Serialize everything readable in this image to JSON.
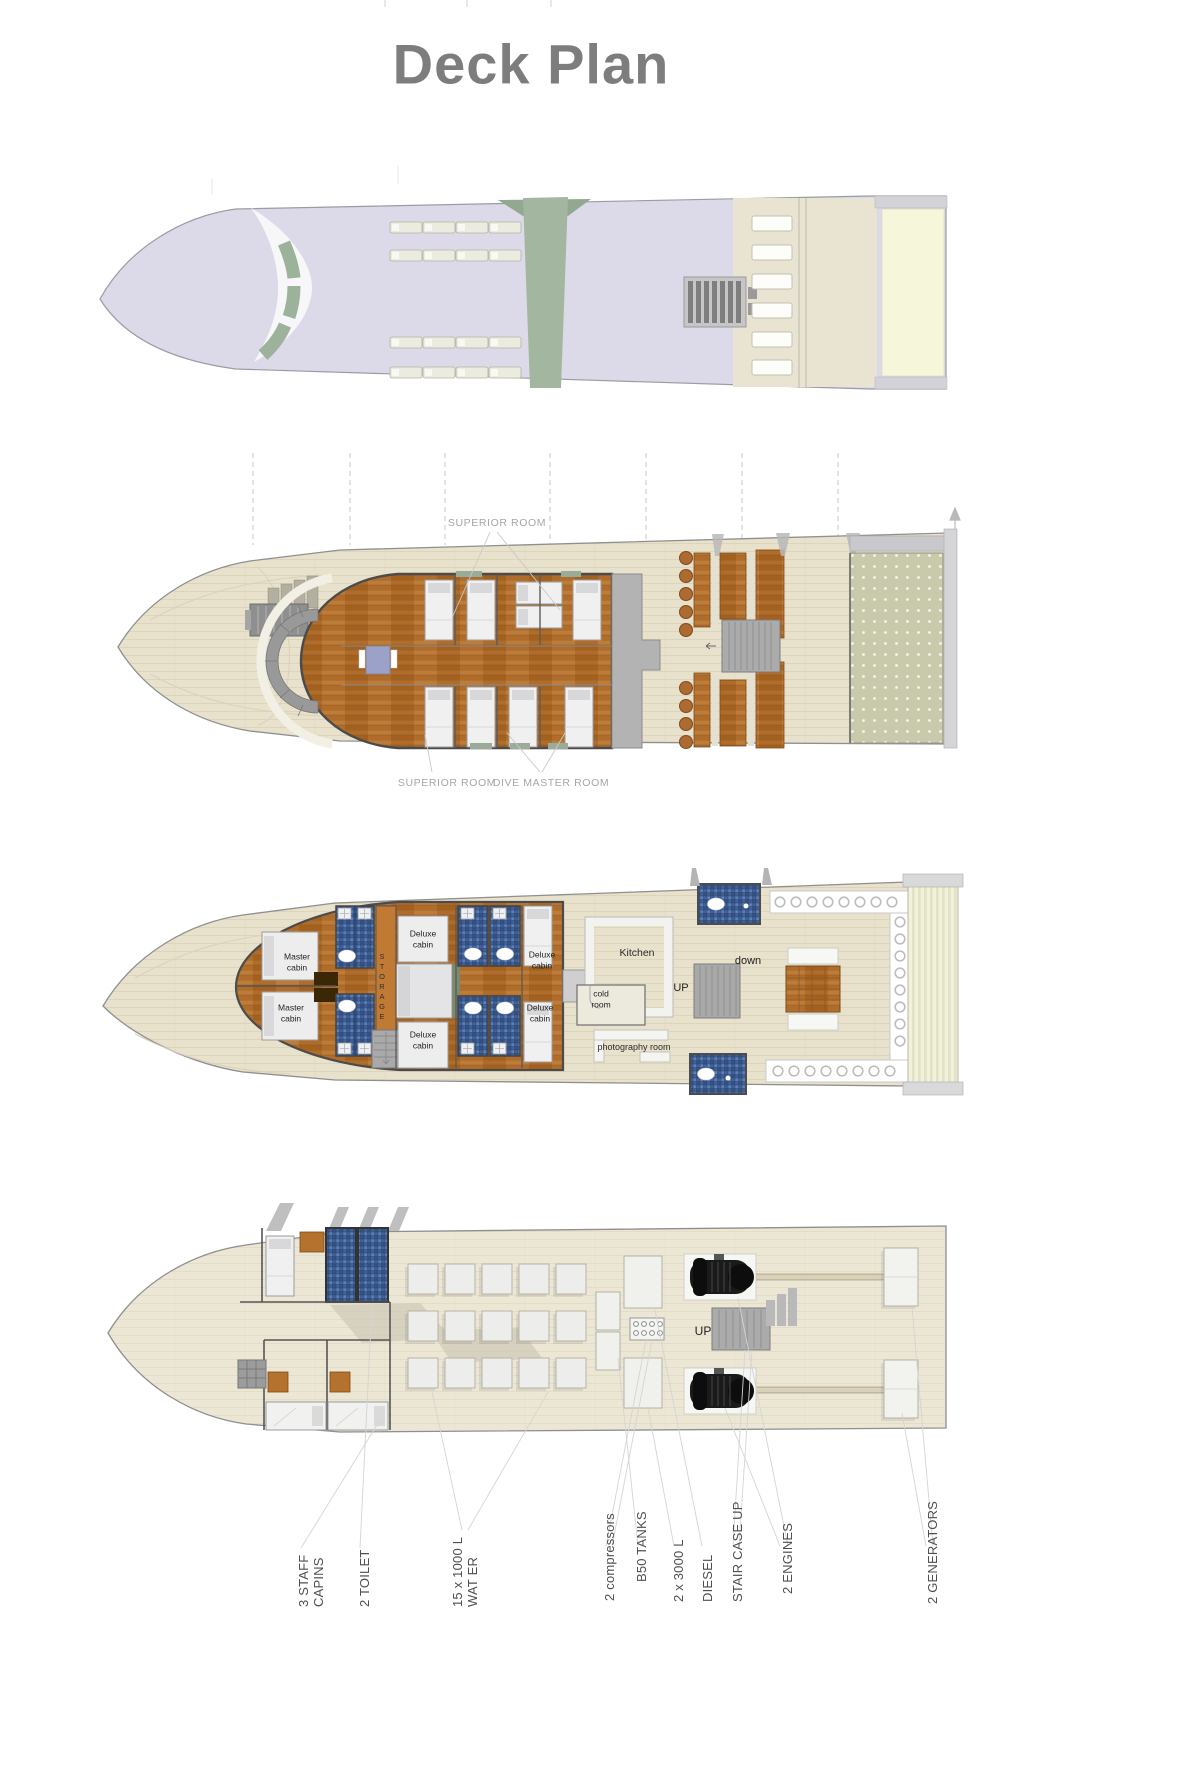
{
  "title": "Deck Plan",
  "upper_deck": {
    "superior_room_top": "SUPERIOR ROOM",
    "superior_room_bottom": "SUPERIOR ROOM",
    "dive_master_room": "DIVE MASTER ROOM"
  },
  "main_deck": {
    "master_cabin": {
      "line1": "Master",
      "line2": "cabin"
    },
    "deluxe_cabin": {
      "line1": "Deluxe",
      "line2": "cabin"
    },
    "storage": "STORAGE",
    "kitchen": "Kitchen",
    "cold_room": {
      "line1": "cold",
      "line2": "room"
    },
    "photography_room": "photography room",
    "stairs_up": "UP",
    "stairs_down": "down"
  },
  "lower_deck": {
    "stairs_up": "UP",
    "callouts": [
      {
        "lines": [
          "3 STAFF",
          "CAPINS"
        ]
      },
      {
        "lines": [
          "2 TOILET"
        ]
      },
      {
        "lines": [
          "15 x 1000 L",
          "WAT ER"
        ]
      },
      {
        "lines": [
          "2 compressors"
        ]
      },
      {
        "lines": [
          "B50 TANKS"
        ]
      },
      {
        "lines": [
          "2 x 3000 L"
        ]
      },
      {
        "lines": [
          "DIESEL"
        ]
      },
      {
        "lines": [
          "STAIR CASE UP"
        ]
      },
      {
        "lines": [
          "2 ENGINES"
        ]
      },
      {
        "lines": [
          "2 GENERATORS"
        ]
      }
    ]
  },
  "colors": {
    "title_gray": "#7d7d7d",
    "hull_wood": "#e8e1cc",
    "cabin_wood": "#b06c2b",
    "mosaic_blue": "#40619a",
    "sun_deck_lavender": "#dcdae8",
    "accent_green": "#a3b7a0"
  }
}
